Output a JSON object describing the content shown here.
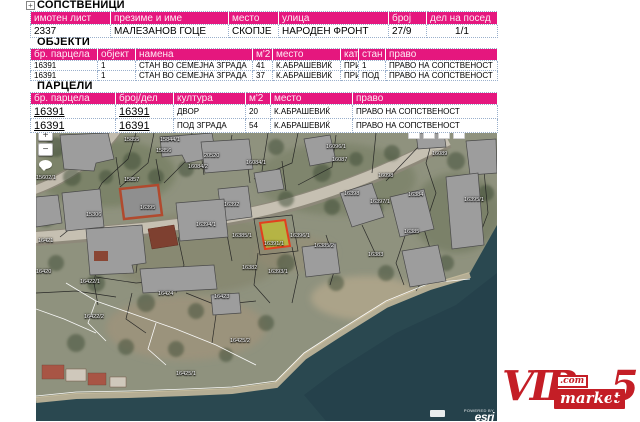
{
  "colors": {
    "table_header_pink": "#E5177E",
    "highlight_fill": "#B9B83F",
    "highlight_stroke": "#E2401E",
    "logo_red": "#C41E26",
    "water": "#2A4850"
  },
  "tree": {
    "expander": "+"
  },
  "sections": {
    "owners": {
      "title": "СОПСТВЕНИЦИ",
      "headers": [
        "имотен лист",
        "презиме и име",
        "место",
        "улица",
        "број",
        "дел на посед"
      ],
      "rows": [
        [
          "2337",
          "МАЛЕЗАНОВ ГОЦЕ",
          "СКОПЈЕ",
          "НАРОДЕН ФРОНТ",
          "27/9",
          "1/1"
        ]
      ],
      "center_cols": [
        5
      ]
    },
    "objects": {
      "title": "ОБЈЕКТИ",
      "headers": [
        "бр. парцела",
        "објект",
        "намена",
        "м'2",
        "место",
        "кат",
        "стан",
        "право"
      ],
      "rows": [
        [
          "16391",
          "1",
          "СТАН ВО СЕМЕЈНА ЗГРАДА",
          "41",
          "К.АБРАШЕВИЌ",
          "ПРИ",
          "1",
          "ПРАВО НА СОПСТВЕНОСТ"
        ],
        [
          "16391",
          "1",
          "СТАН ВО СЕМЕЈНА ЗГРАДА",
          "37",
          "К.АБРАШЕВИЌ",
          "ПРИ",
          "ПОД",
          "ПРАВО НА СОПСТВЕНОСТ"
        ]
      ]
    },
    "parcels": {
      "title": "ПАРЦЕЛИ",
      "headers": [
        "бр. парцела",
        "број/дел",
        "култура",
        "м'2",
        "место",
        "право"
      ],
      "rows": [
        [
          "16391",
          "16391",
          "ДВОР",
          "20",
          "К.АБРАШЕВИЌ",
          "ПРАВО НА СОПСТВЕНОСТ"
        ],
        [
          "16391",
          "16391",
          "ПОД ЗГРАДА",
          "54",
          "К.АБРАШЕВИЌ",
          "ПРАВО НА СОПСТВЕНОСТ"
        ]
      ],
      "link_cols": [
        0,
        1
      ]
    }
  },
  "map": {
    "controls": {
      "zoom_in": "+",
      "zoom_out": "−"
    },
    "attribution": {
      "powered_by": "POWERED BY",
      "brand": "esri"
    },
    "highlighted_parcel": "16391/1",
    "labels": [
      {
        "t": "15855",
        "x": 88,
        "y": 4
      },
      {
        "t": "15844/1",
        "x": 124,
        "y": 4
      },
      {
        "t": "15856",
        "x": 120,
        "y": 15
      },
      {
        "t": "20520",
        "x": 168,
        "y": 20
      },
      {
        "t": "16084/2",
        "x": 152,
        "y": 31
      },
      {
        "t": "16084/1",
        "x": 210,
        "y": 27
      },
      {
        "t": "16096/1",
        "x": 290,
        "y": 11
      },
      {
        "t": "16087",
        "x": 296,
        "y": 24
      },
      {
        "t": "16089",
        "x": 396,
        "y": 18
      },
      {
        "t": "16098",
        "x": 342,
        "y": 40
      },
      {
        "t": "15857",
        "x": 88,
        "y": 44
      },
      {
        "t": "15602/1",
        "x": 0,
        "y": 42
      },
      {
        "t": "16395",
        "x": 104,
        "y": 72
      },
      {
        "t": "16392",
        "x": 188,
        "y": 69
      },
      {
        "t": "16394/1",
        "x": 160,
        "y": 89
      },
      {
        "t": "16398",
        "x": 308,
        "y": 58
      },
      {
        "t": "16397/1",
        "x": 334,
        "y": 66
      },
      {
        "t": "16384",
        "x": 372,
        "y": 59
      },
      {
        "t": "16395/1",
        "x": 428,
        "y": 64
      },
      {
        "t": "16385/1",
        "x": 196,
        "y": 100
      },
      {
        "t": "16391/1",
        "x": 228,
        "y": 108
      },
      {
        "t": "16396/1",
        "x": 254,
        "y": 100
      },
      {
        "t": "16385/2",
        "x": 278,
        "y": 110
      },
      {
        "t": "16385",
        "x": 368,
        "y": 96
      },
      {
        "t": "16383",
        "x": 332,
        "y": 119
      },
      {
        "t": "15306",
        "x": 50,
        "y": 79
      },
      {
        "t": "16421",
        "x": 2,
        "y": 105
      },
      {
        "t": "16382",
        "x": 206,
        "y": 132
      },
      {
        "t": "16393/1",
        "x": 232,
        "y": 136
      },
      {
        "t": "16420",
        "x": 0,
        "y": 136
      },
      {
        "t": "16422/1",
        "x": 44,
        "y": 146
      },
      {
        "t": "16424",
        "x": 122,
        "y": 158
      },
      {
        "t": "16423",
        "x": 178,
        "y": 161
      },
      {
        "t": "16422/2",
        "x": 48,
        "y": 181
      },
      {
        "t": "16425/2",
        "x": 194,
        "y": 205
      },
      {
        "t": "16425/1",
        "x": 140,
        "y": 238
      }
    ]
  },
  "logo": {
    "vip": "VIP",
    "com": ".com",
    "market": "market",
    "five": "5"
  }
}
